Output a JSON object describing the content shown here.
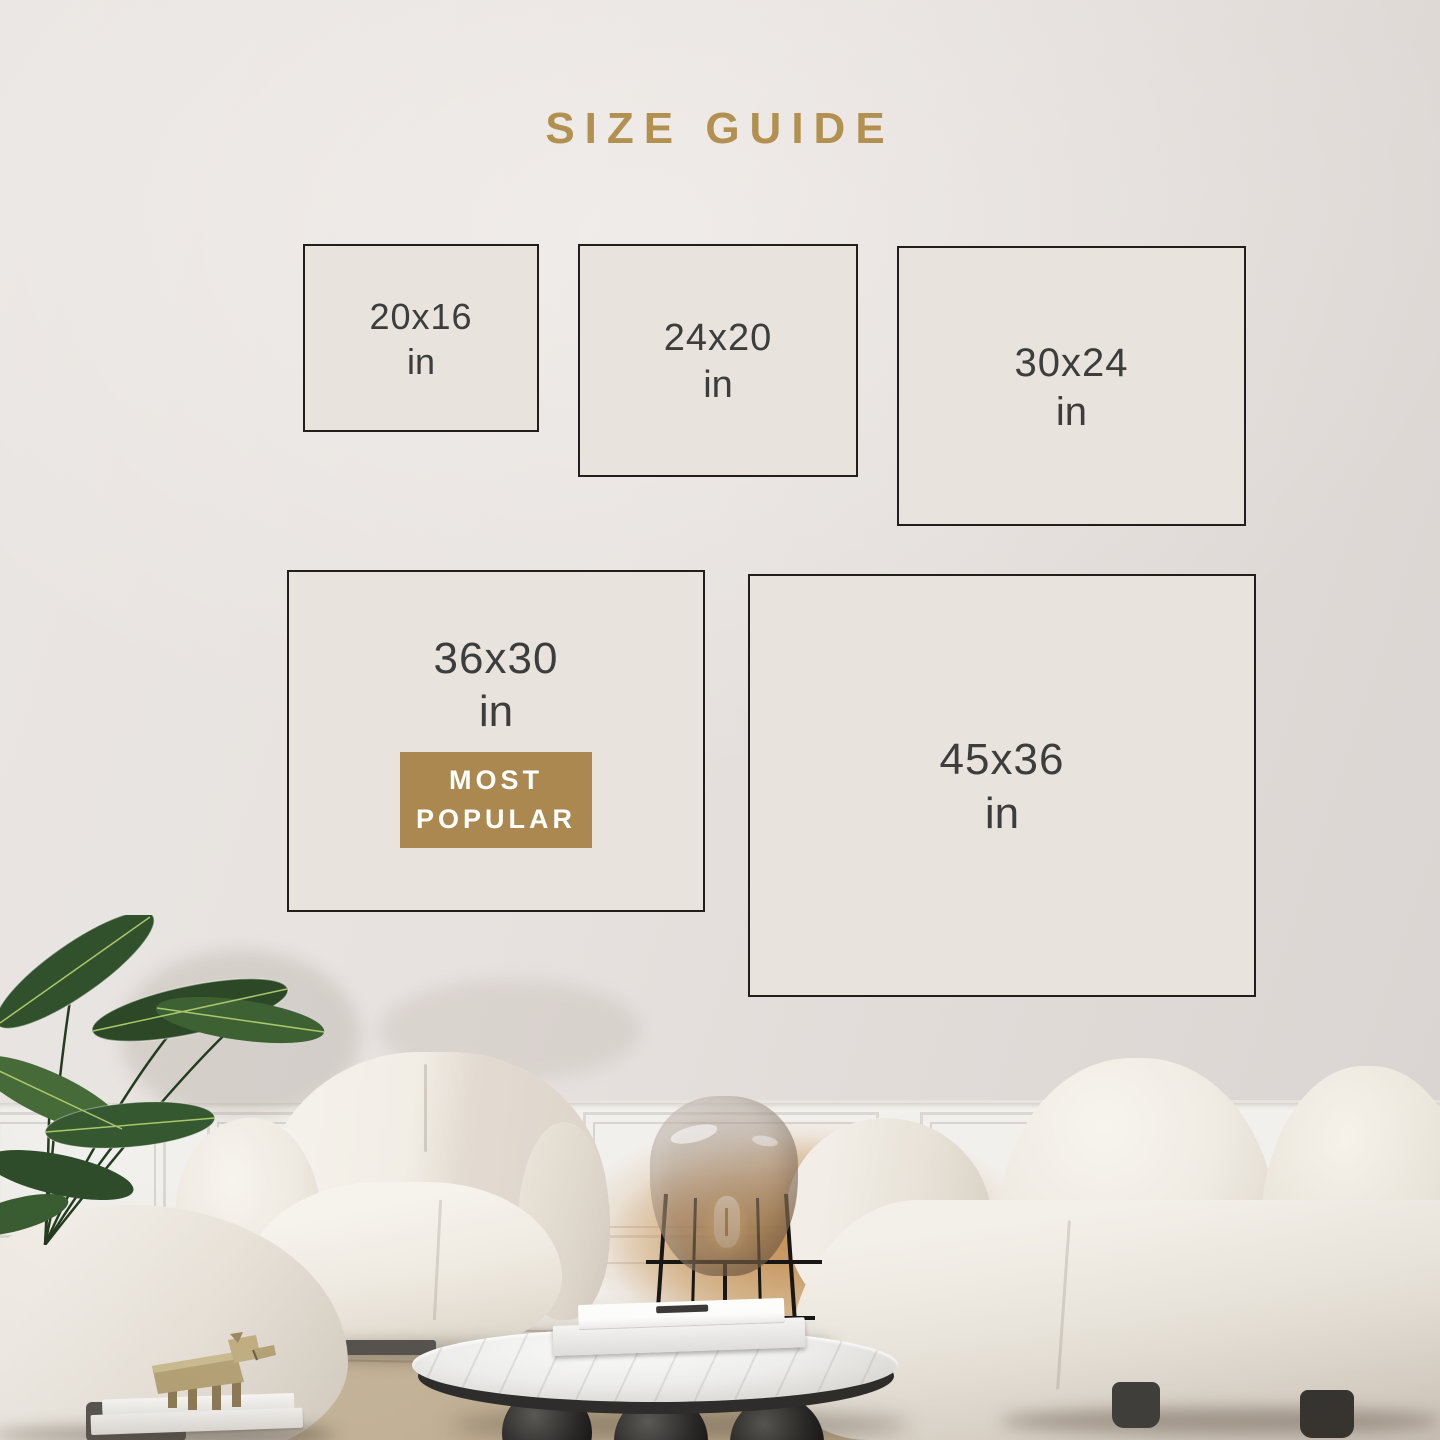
{
  "title": {
    "text": "SIZE GUIDE"
  },
  "sizes": [
    {
      "label": "20x16",
      "unit": "in"
    },
    {
      "label": "24x20",
      "unit": "in"
    },
    {
      "label": "30x24",
      "unit": "in"
    },
    {
      "label": "36x30",
      "unit": "in",
      "most_popular": true
    },
    {
      "label": "45x36",
      "unit": "in"
    }
  ],
  "badge": {
    "line1": "MOST",
    "line2": "POPULAR"
  },
  "colors": {
    "accent_gold": "#b2904f",
    "badge_gold": "#ab8850",
    "badge_text": "#ffffff",
    "frame_border": "#201f1d",
    "frame_fill": "#e8e3dd",
    "label_text": "#3d3d3d"
  }
}
